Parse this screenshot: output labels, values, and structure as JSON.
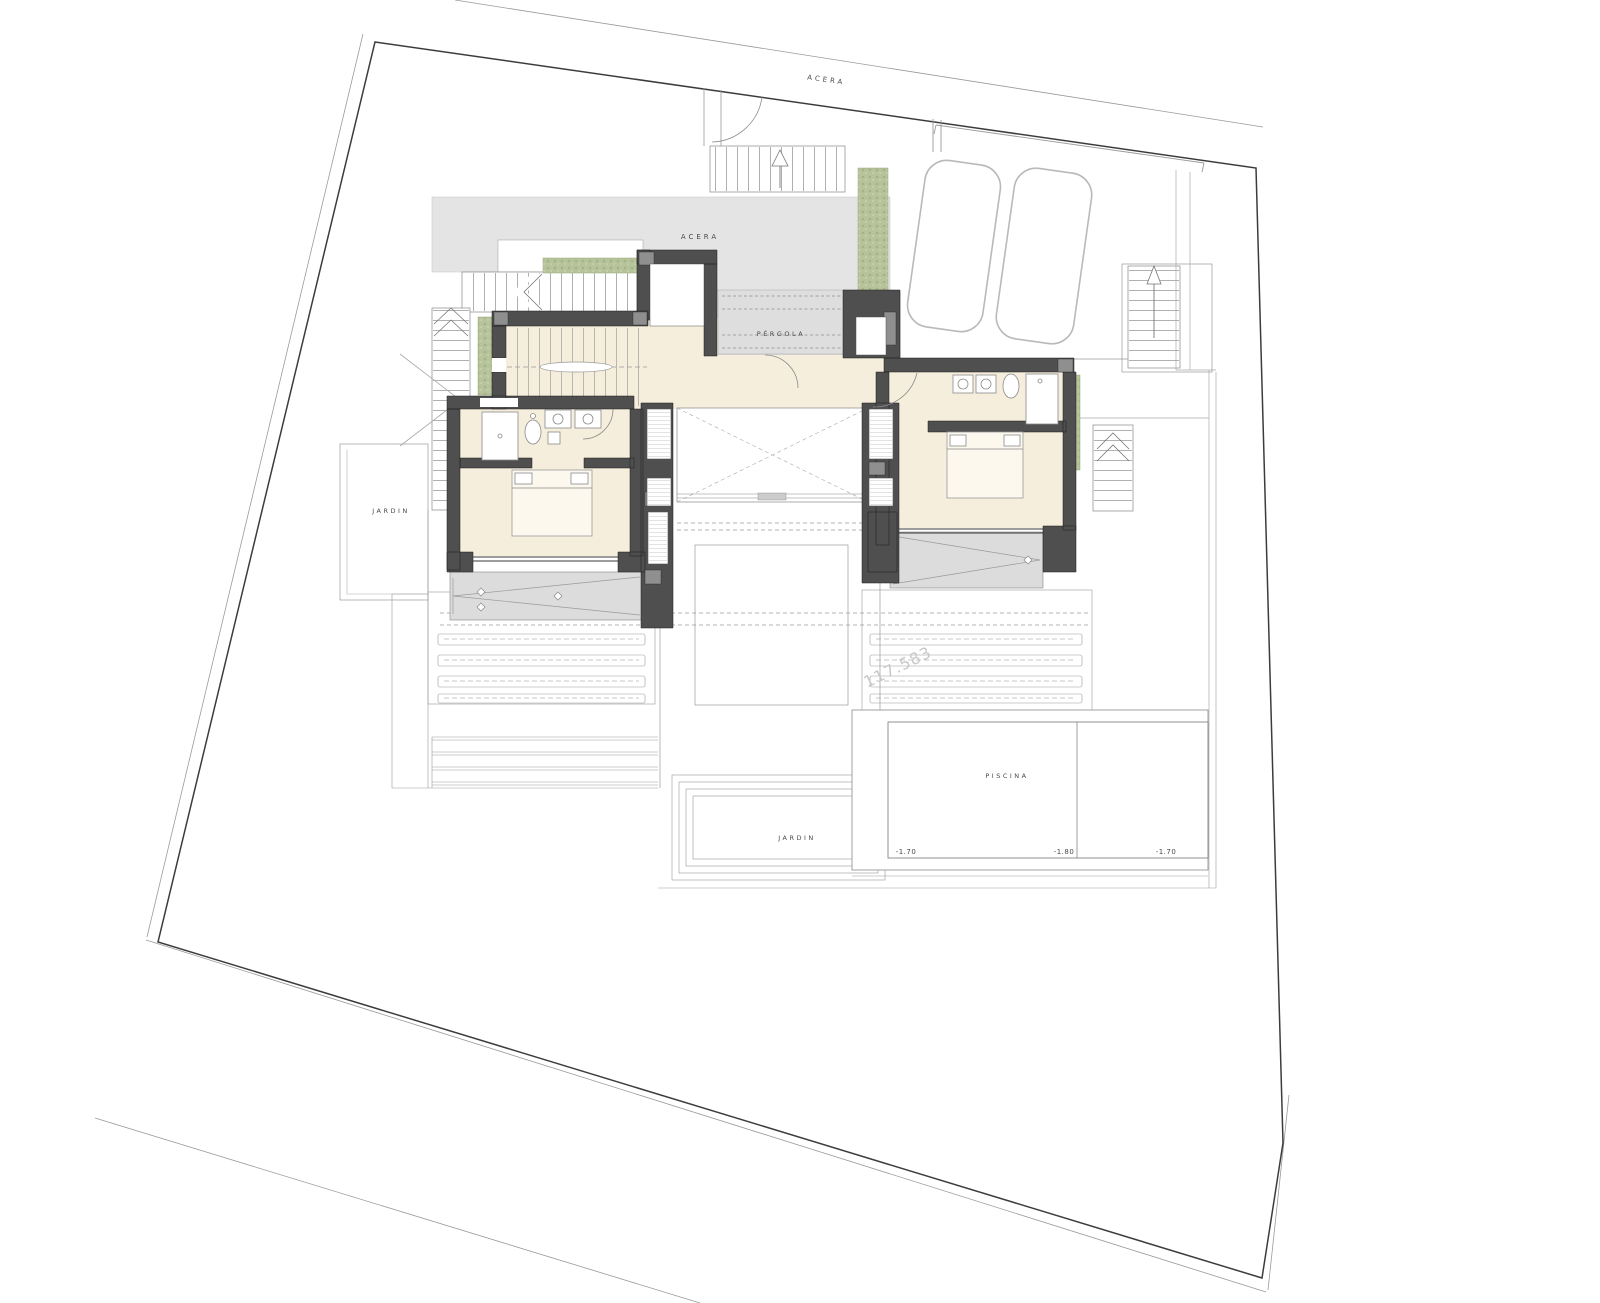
{
  "plan": {
    "labels": {
      "street": "ACERA",
      "terrace": "ACERA",
      "pergola": "PÉRGOLA",
      "garden_left": "JARDIN",
      "garden_bottom": "JARDIN",
      "pool": "PISCINA",
      "pool_depth_left": "-1.70",
      "pool_depth_middle": "-1.80",
      "pool_depth_right": "-1.70",
      "watermark": "117.583"
    },
    "colors": {
      "background": "#ffffff",
      "boundary_line": "#3c3c3c",
      "thin_line": "#9a9a9a",
      "paving": "#e4e4e4",
      "pergola_band": "#dedede",
      "wall": "#4f4f4f",
      "wall_post": "#8f8f8f",
      "floor": "#f6eedc",
      "terrace_hatch": "#dcdcdc",
      "planter_green": "#b7c39a",
      "car_outline": "#b9b9b9",
      "label_text": "#4a4a4a",
      "watermark_text": "#c9c9c9"
    }
  }
}
